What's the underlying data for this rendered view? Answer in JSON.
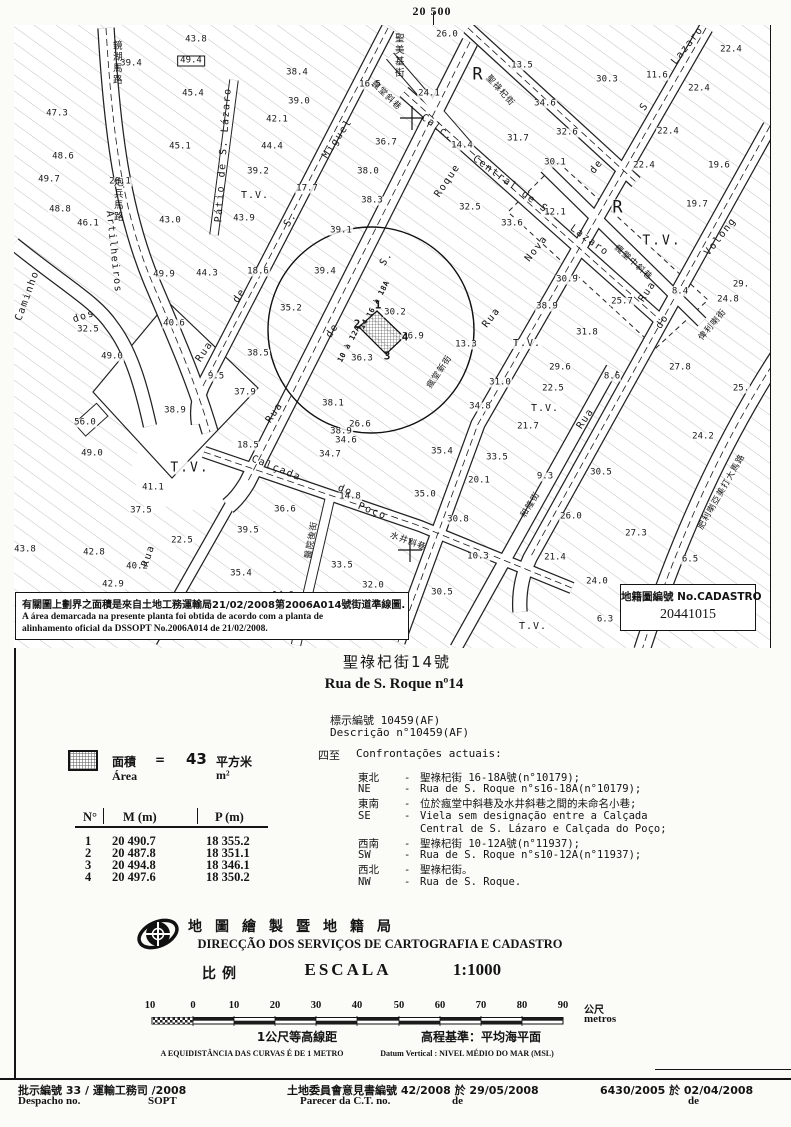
{
  "frame": {
    "grid_top": "20 500",
    "grid_right_upper": "18 400",
    "grid_right_lower": "18 300"
  },
  "map": {
    "note": {
      "zh": "有關圖上劃界之面積是來自土地工務運輸局21/02/2008第2006A014號街道準線圖.",
      "pt1": "A área demarcada na presente planta foi obtida de acordo com a planta de",
      "pt2": "alinhamento oficial da DSSOPT  No.2006A014 de 21/02/2008."
    },
    "cadastro": {
      "label": "地籍圖編號 No.CADASTRO",
      "number": "20441015"
    },
    "labels": [
      [
        "39.4",
        131,
        64
      ],
      [
        "43.8",
        196,
        40
      ],
      [
        "49.4",
        191,
        61,
        0,
        "nx"
      ],
      [
        "45.4",
        193,
        94
      ],
      [
        "47.3",
        57,
        114
      ],
      [
        "45.1",
        180,
        147
      ],
      [
        "48.6",
        63,
        157
      ],
      [
        "49.7",
        49,
        180
      ],
      [
        "20.1",
        120,
        182
      ],
      [
        "48.8",
        60,
        210
      ],
      [
        "46.1",
        88,
        224
      ],
      [
        "43.0",
        170,
        221
      ],
      [
        "38.4",
        297,
        73
      ],
      [
        "39.0",
        299,
        102
      ],
      [
        "42.1",
        277,
        120
      ],
      [
        "44.4",
        272,
        147
      ],
      [
        "39.2",
        258,
        172
      ],
      [
        "43.9",
        244,
        219
      ],
      [
        "17.7",
        307,
        189
      ],
      [
        "16.5",
        370,
        85
      ],
      [
        "38.0",
        368,
        172
      ],
      [
        "38.3",
        372,
        201
      ],
      [
        "39.1",
        341,
        231
      ],
      [
        "36.7",
        386,
        143
      ],
      [
        "49.9",
        164,
        275
      ],
      [
        "44.3",
        207,
        274
      ],
      [
        "18.6",
        258,
        272
      ],
      [
        "39.4",
        325,
        272
      ],
      [
        "35.2",
        291,
        309
      ],
      [
        "40.6",
        174,
        324
      ],
      [
        "32.5",
        88,
        330
      ],
      [
        "49.0",
        112,
        357
      ],
      [
        "38.5",
        258,
        354
      ],
      [
        "9.5",
        216,
        377
      ],
      [
        "37.9",
        245,
        393
      ],
      [
        "38.9",
        175,
        411
      ],
      [
        "56.0",
        85,
        423
      ],
      [
        "49.0",
        92,
        454
      ],
      [
        "18.5",
        248,
        446
      ],
      [
        "41.1",
        153,
        488
      ],
      [
        "37.5",
        141,
        511
      ],
      [
        "36.6",
        285,
        510
      ],
      [
        "39.5",
        248,
        531
      ],
      [
        "22.5",
        182,
        541
      ],
      [
        "43.8",
        25,
        550
      ],
      [
        "42.8",
        94,
        553
      ],
      [
        "40.2",
        137,
        567
      ],
      [
        "35.4",
        241,
        574
      ],
      [
        "42.9",
        113,
        585
      ],
      [
        "14.6",
        283,
        596
      ],
      [
        "38.1",
        333,
        404
      ],
      [
        "26.6",
        360,
        425
      ],
      [
        "38.9",
        341,
        432
      ],
      [
        "34.6",
        346,
        441
      ],
      [
        "34.7",
        330,
        455
      ],
      [
        "14.8",
        350,
        497
      ],
      [
        "33.5",
        342,
        566
      ],
      [
        "32.0",
        373,
        586
      ],
      [
        "30.5",
        442,
        593
      ],
      [
        "35.4",
        442,
        452
      ],
      [
        "35.0",
        425,
        495
      ],
      [
        "30.8",
        458,
        520
      ],
      [
        "20.1",
        479,
        481
      ],
      [
        "10.3",
        478,
        557
      ],
      [
        "33.5",
        497,
        458
      ],
      [
        "9.3",
        545,
        477
      ],
      [
        "30.5",
        601,
        473
      ],
      [
        "21.7",
        528,
        427
      ],
      [
        "26.0",
        571,
        517
      ],
      [
        "27.3",
        636,
        534
      ],
      [
        "21.4",
        555,
        558
      ],
      [
        "24.0",
        597,
        582
      ],
      [
        "24.2",
        703,
        437
      ],
      [
        "6.5",
        690,
        560
      ],
      [
        "6.3",
        605,
        620
      ],
      [
        "26.0",
        447,
        35
      ],
      [
        "13.5",
        522,
        66
      ],
      [
        "24.1",
        429,
        94
      ],
      [
        "34.6",
        545,
        104
      ],
      [
        "30.3",
        607,
        80
      ],
      [
        "11.6",
        657,
        76
      ],
      [
        "22.4",
        731,
        50
      ],
      [
        "22.4",
        699,
        89
      ],
      [
        "31.7",
        518,
        139
      ],
      [
        "32.6",
        567,
        133
      ],
      [
        "22.4",
        668,
        132
      ],
      [
        "14.4",
        462,
        146
      ],
      [
        "30.1",
        555,
        163
      ],
      [
        "22.4",
        644,
        166
      ],
      [
        "19.6",
        719,
        166
      ],
      [
        "19.7",
        697,
        205
      ],
      [
        "32.5",
        470,
        208
      ],
      [
        "33.6",
        512,
        224
      ],
      [
        "12.1",
        555,
        213
      ],
      [
        "30.9",
        567,
        280
      ],
      [
        "38.9",
        547,
        307
      ],
      [
        "25.7",
        622,
        302
      ],
      [
        "8.4",
        680,
        292
      ],
      [
        "29.",
        741,
        285
      ],
      [
        "24.8",
        728,
        300
      ],
      [
        "25.",
        741,
        389
      ],
      [
        "31.8",
        587,
        333
      ],
      [
        "29.6",
        560,
        368
      ],
      [
        "22.5",
        553,
        389
      ],
      [
        "31.0",
        500,
        383
      ],
      [
        "34.8",
        480,
        407
      ],
      [
        "13.3",
        466,
        345
      ],
      [
        "27.8",
        680,
        368
      ],
      [
        "8.6",
        612,
        377
      ],
      [
        "30.2",
        395,
        313
      ],
      [
        "36.9",
        413,
        337
      ],
      [
        "36.3",
        362,
        359
      ],
      [
        "1",
        378,
        305,
        0,
        "nb"
      ],
      [
        "2",
        357,
        324,
        0,
        "nb"
      ],
      [
        "3",
        387,
        356,
        0,
        "nb"
      ],
      [
        "4",
        405,
        337,
        0,
        "nb"
      ],
      [
        "10 à 12A",
        349,
        344,
        -62,
        "ns"
      ],
      [
        "14",
        364,
        324,
        -62,
        "ns"
      ],
      [
        "16 à 18A",
        378,
        299,
        -62,
        "ns"
      ],
      [
        "R",
        478,
        75,
        0,
        "R"
      ],
      [
        "R",
        618,
        208,
        0,
        "R"
      ],
      [
        "T.V.",
        255,
        196,
        0,
        "tv2"
      ],
      [
        "T.V.",
        662,
        241,
        0,
        "tv"
      ],
      [
        "T.V.",
        527,
        344,
        0,
        "tv2"
      ],
      [
        "T.V.",
        545,
        409,
        0,
        "tv2"
      ],
      [
        "T.V.",
        190,
        468,
        0,
        "tv"
      ],
      [
        "T.V.",
        533,
        627,
        0,
        "tv2"
      ],
      [
        "Rua",
        205,
        352,
        -56,
        "s"
      ],
      [
        "de",
        240,
        296,
        -56,
        "s"
      ],
      [
        "S.",
        291,
        220,
        -56,
        "s"
      ],
      [
        "Miguel",
        338,
        139,
        -56,
        "s"
      ],
      [
        "Rua",
        275,
        413,
        -56,
        "s"
      ],
      [
        "de",
        333,
        331,
        -56,
        "s"
      ],
      [
        "S.",
        387,
        259,
        -56,
        "s"
      ],
      [
        "Roque",
        448,
        181,
        -56,
        "s"
      ],
      [
        "Rua",
        492,
        318,
        -52,
        "s"
      ],
      [
        "Nova",
        537,
        249,
        -52,
        "s"
      ],
      [
        "de",
        597,
        167,
        -52,
        "s"
      ],
      [
        "S",
        645,
        107,
        -52,
        "s"
      ],
      [
        "Lazaro",
        688,
        46,
        -52,
        "s"
      ],
      [
        "Calc.",
        437,
        128,
        36,
        "s"
      ],
      [
        "Central de S.",
        513,
        187,
        36,
        "s"
      ],
      [
        "Lazaro",
        589,
        241,
        36,
        "s"
      ],
      [
        "Calçada",
        276,
        469,
        22,
        "s"
      ],
      [
        "do",
        345,
        491,
        22,
        "s"
      ],
      [
        "Poço",
        372,
        512,
        22,
        "s"
      ],
      [
        "Rua",
        586,
        419,
        -56,
        "s"
      ],
      [
        "Rua",
        648,
        292,
        -56,
        "s"
      ],
      [
        "do",
        663,
        322,
        -56,
        "s"
      ],
      [
        "Volong",
        721,
        237,
        -52,
        "s"
      ],
      [
        "Caminho",
        28,
        296,
        -70,
        "s"
      ],
      [
        "dos",
        84,
        317,
        -18,
        "s"
      ],
      [
        "Artilheiros",
        113,
        252,
        84,
        "s"
      ],
      [
        "Rua",
        149,
        556,
        -72,
        "s"
      ],
      [
        "Pátio de S. Lázaro",
        224,
        155,
        -86,
        "s"
      ],
      [
        "聖祿杞街",
        500,
        91,
        48,
        "cz"
      ],
      [
        "瘋堂斜巷",
        386,
        96,
        44,
        "cz"
      ],
      [
        "瘋堂中斜巷",
        633,
        263,
        42,
        "cz"
      ],
      [
        "瘋堂新街",
        440,
        372,
        -56,
        "cz"
      ],
      [
        "水井斜巷",
        408,
        542,
        20,
        "cz"
      ],
      [
        "和隆街",
        531,
        505,
        -58,
        "cz"
      ],
      [
        "肥利喇亞美打大馬路",
        722,
        492,
        -60,
        "cz"
      ],
      [
        "醫院後街",
        312,
        540,
        -80,
        "cz"
      ],
      [
        "俾利喇街",
        713,
        325,
        -50,
        "cz"
      ],
      [
        "鏡湖馬路",
        116,
        63,
        0,
        "cv"
      ],
      [
        "炮兵馬路",
        117,
        200,
        0,
        "cv"
      ],
      [
        "聖美基街",
        398,
        56,
        0,
        "cv"
      ]
    ]
  },
  "title": {
    "zh": "聖祿杞街14號",
    "pt": "Rua de S. Roque nº14"
  },
  "descricao": {
    "zh": "標示編號 10459(AF)",
    "pt": "Descrição n°10459(AF)"
  },
  "confrontations": {
    "heading_zh": "四至",
    "heading_pt": "Confrontações actuais:",
    "rows": [
      {
        "d": "東北",
        "h": "-",
        "t": "聖祿杞街 16-18A號(n°10179);"
      },
      {
        "d": "NE",
        "h": "-",
        "t": "Rua de S. Roque n°s16-18A(n°10179);"
      },
      {
        "d": "東南",
        "h": "-",
        "t": "位於瘋堂中斜巷及水井斜巷之間的未命名小巷;"
      },
      {
        "d": "SE",
        "h": "-",
        "t": "Viela sem designação entre a Calçada"
      },
      {
        "d": "",
        "h": "",
        "t": "Central de S. Lázaro e Calçada do Poço;"
      },
      {
        "d": "西南",
        "h": "-",
        "t": "聖祿杞街 10-12A號(n°11937);"
      },
      {
        "d": "SW",
        "h": "-",
        "t": "Rua de S. Roque n°s10-12A(n°11937);"
      },
      {
        "d": "西北",
        "h": "-",
        "t": "聖祿杞街。"
      },
      {
        "d": "NW",
        "h": "-",
        "t": "Rua de S. Roque."
      }
    ]
  },
  "legend": {
    "area_zh": "面積",
    "eq": "=",
    "value": "43",
    "unit_zh": "平方米",
    "area_pt": "Área",
    "unit_pt": "m²"
  },
  "coords_table": {
    "headers": [
      "N°",
      "M (m)",
      "P (m)"
    ],
    "rows": [
      [
        "1",
        "20 490.7",
        "18 355.2"
      ],
      [
        "2",
        "20 487.8",
        "18 351.1"
      ],
      [
        "3",
        "20 494.8",
        "18 346.1"
      ],
      [
        "4",
        "20 497.6",
        "18 350.2"
      ]
    ]
  },
  "agency": {
    "zh": "地圖繪製暨地籍局",
    "pt": "DIRECÇÃO DOS SERVIÇOS DE CARTOGRAFIA E CADASTRO",
    "scale_zh": "比例",
    "scale_pt": "ESCALA",
    "scale_value": "1:1000"
  },
  "scalebar": {
    "ticks": [
      "10",
      "0",
      "10",
      "20",
      "30",
      "40",
      "50",
      "60",
      "70",
      "80",
      "90"
    ],
    "unit_zh": "公尺",
    "unit_pt": "metros"
  },
  "notes": {
    "contour_zh": "1公尺等高線距",
    "contour_pt": "A EQUIDISTÂNCIA DAS CURVAS É DE 1 METRO",
    "datum_zh": "高程基準：平均海平面",
    "datum_pt": "Datum Vertical : NIVEL MÉDIO DO MAR (MSL)"
  },
  "footer": {
    "despacho_zh": "批示編號  33   / 運輸工務司 /2008",
    "despacho_pt": "Despacho no.",
    "despacho_org": "SOPT",
    "parecer_zh": "土地委員會意見書編號 42/2008 於 29/05/2008",
    "parecer_pt": "Parecer da C.T. no.",
    "parecer_de": "de",
    "ref": "6430/2005 於 02/04/2008",
    "ref_de": "de"
  }
}
